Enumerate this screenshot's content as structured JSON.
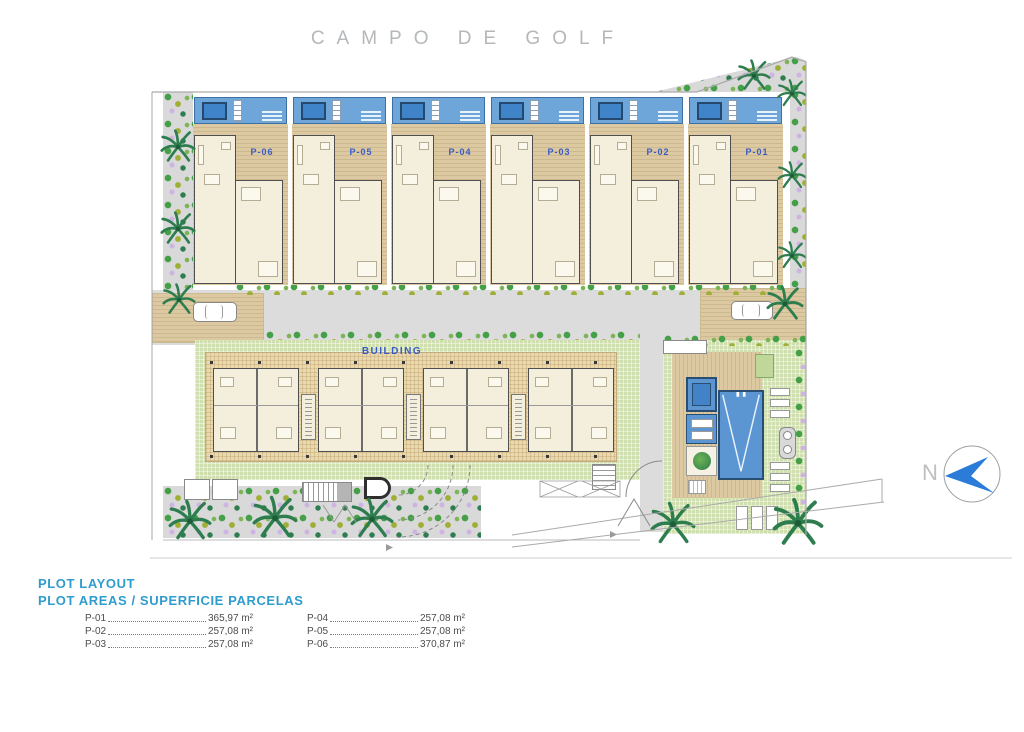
{
  "title": "CAMPO DE GOLF",
  "site": {
    "building_label": "BUILDING",
    "row_plots": [
      "P-06",
      "P-05",
      "P-04",
      "P-03",
      "P-02",
      "P-01"
    ]
  },
  "north": {
    "label": "N"
  },
  "legend": {
    "title": "PLOT LAYOUT",
    "subtitle": "PLOT AREAS / SUPERFICIE PARCELAS",
    "columns": [
      [
        {
          "id": "P-01",
          "area": "365,97 m²"
        },
        {
          "id": "P-02",
          "area": "257,08 m²"
        },
        {
          "id": "P-03",
          "area": "257,08 m²"
        }
      ],
      [
        {
          "id": "P-04",
          "area": "257,08 m²"
        },
        {
          "id": "P-05",
          "area": "257,08 m²"
        },
        {
          "id": "P-06",
          "area": "370,87 m²"
        }
      ]
    ]
  },
  "colors": {
    "accent_blue": "#2f9cce",
    "plot_label_blue": "#3a5ac6",
    "terrace_blue": "#6fa6da",
    "pool_blue": "#5b95d2",
    "lawn_green": "#cfdfae",
    "deck_tan": "#dcc9a2",
    "road_gray": "#dcdcdc",
    "title_gray": "#b4b8ba"
  }
}
